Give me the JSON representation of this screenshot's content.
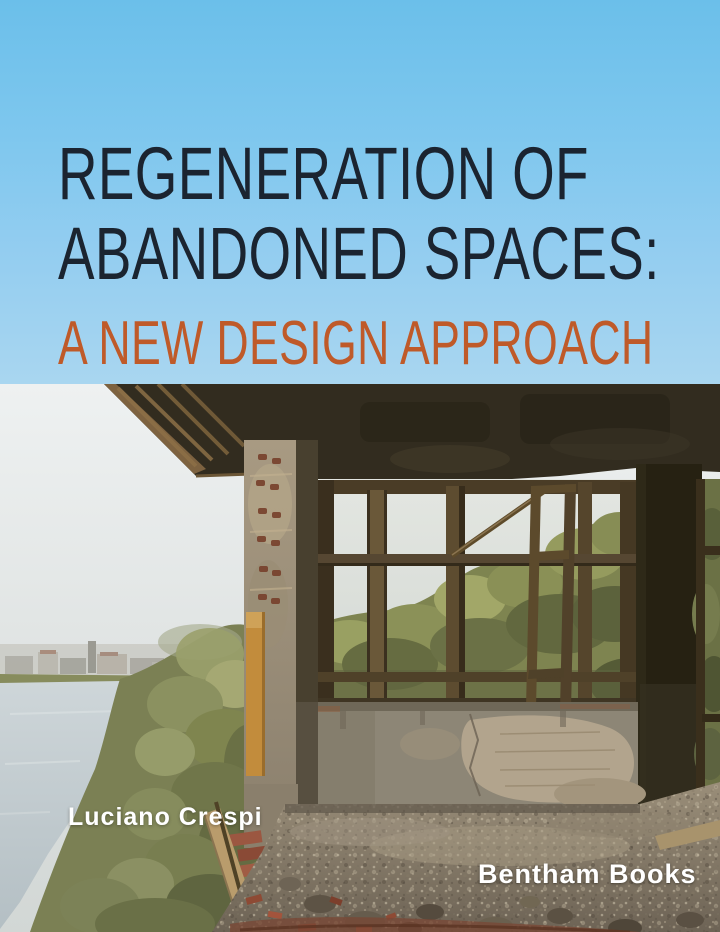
{
  "cover": {
    "title": {
      "line1": "REGENERATION OF",
      "line2": "ABANDONED SPACES:",
      "subtitle": "A NEW DESIGN APPROACH"
    },
    "author": "Luciano Crespi",
    "publisher": "Bentham Books",
    "colors": {
      "sky_top": "#6bbfea",
      "sky_bottom": "#a9d6f0",
      "title_text": "#1b2430",
      "subtitle_text": "#bf5a29",
      "author_text": "#ffffff",
      "publisher_text": "#ffffff"
    }
  }
}
